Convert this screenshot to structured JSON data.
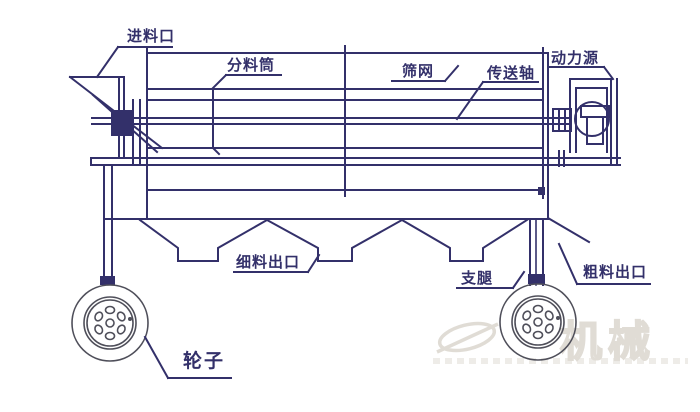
{
  "diagram": {
    "labels": {
      "feed_inlet": "进料口",
      "distributor_drum": "分料筒",
      "screen_mesh": "筛网",
      "drive_shaft": "传送轴",
      "power_source": "动力源",
      "fine_material_outlet": "细料出口",
      "support_leg": "支腿",
      "coarse_material_outlet": "粗料出口",
      "wheel": "轮子"
    },
    "watermark": {
      "text": "机械"
    },
    "colors": {
      "line": "#33306a",
      "wheel_line": "#4f4f5a",
      "watermark": "#c7c0b4",
      "background": "#ffffff"
    }
  }
}
